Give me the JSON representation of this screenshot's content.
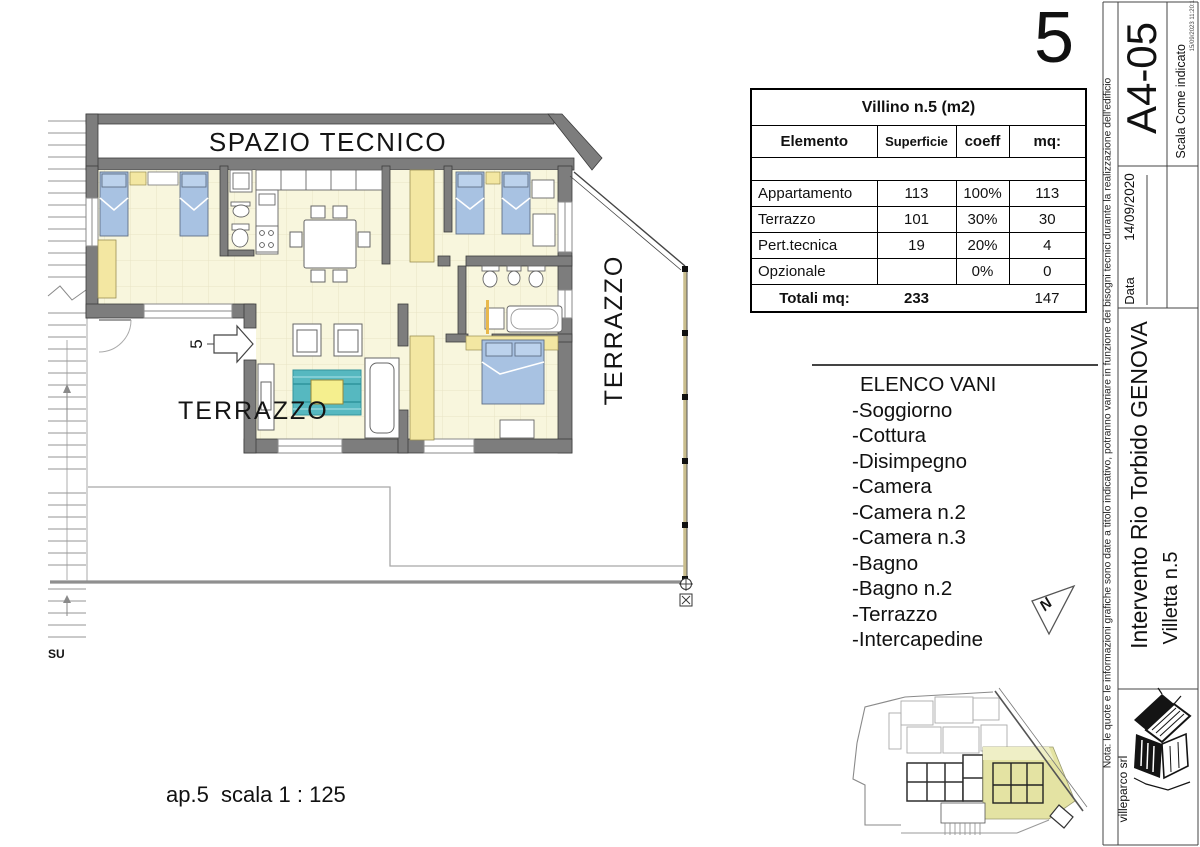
{
  "sheet": {
    "number": "5",
    "scale_note": "ap.5  scala 1 : 125"
  },
  "plan": {
    "labels": {
      "spazio_tecnico": "SPAZIO TECNICO",
      "terrazzo_left": "TERRAZZO",
      "terrazzo_right": "TERRAZZO",
      "entrance_number": "5",
      "stairs": "SU",
      "north": "N"
    }
  },
  "area_table": {
    "title": "Villino n.5 (m2)",
    "headers": {
      "elemento": "Elemento",
      "superficie": "Superficie",
      "coeff": "coeff",
      "mq": "mq:"
    },
    "rows": [
      {
        "elemento": "Appartamento",
        "superficie": "113",
        "coeff": "100%",
        "mq": "113"
      },
      {
        "elemento": "Terrazzo",
        "superficie": "101",
        "coeff": "30%",
        "mq": "30"
      },
      {
        "elemento": "Pert.tecnica",
        "superficie": "19",
        "coeff": "20%",
        "mq": "4"
      },
      {
        "elemento": "Opzionale",
        "superficie": "",
        "coeff": "0%",
        "mq": "0"
      }
    ],
    "totals": {
      "label": "Totali mq:",
      "superficie": "233",
      "coeff": "",
      "mq": "147"
    }
  },
  "room_list": {
    "title": "ELENCO VANI",
    "items": [
      "-Soggiorno",
      "-Cottura",
      "-Disimpegno",
      "-Camera",
      "-Camera n.2",
      "-Camera n.3",
      "-Bagno",
      "-Bagno n.2",
      "-Terrazzo",
      "-Intercapedine"
    ]
  },
  "title_block": {
    "drawing_code": "A4-05",
    "scale_label": "Scala",
    "scale_value": "Come indicato",
    "print_stamp": "15/09/2023 11:20:16",
    "date_label": "Data",
    "date_value": "14/09/2020",
    "project_title": "Intervento Rio Torbido GENOVA",
    "unit_title": "Villetta n.5",
    "company": "villeparco srl",
    "note": "Nota: le quote e le informazioni grafiche sono date a titolo indicativo, potranno variare in funzione dei bisogni tecnici  durante la realizzazione dell'edificio"
  },
  "colors": {
    "wall": "#7d7d7d",
    "floor": "#f8f6dd",
    "furniture_blue": "#a8c2e2",
    "furniture_yellow": "#f3e7a2",
    "rug_teal": "#56b8c0",
    "rug_table_yellow": "#f5ef8e",
    "keymap_highlight": "#e4e3a3"
  }
}
